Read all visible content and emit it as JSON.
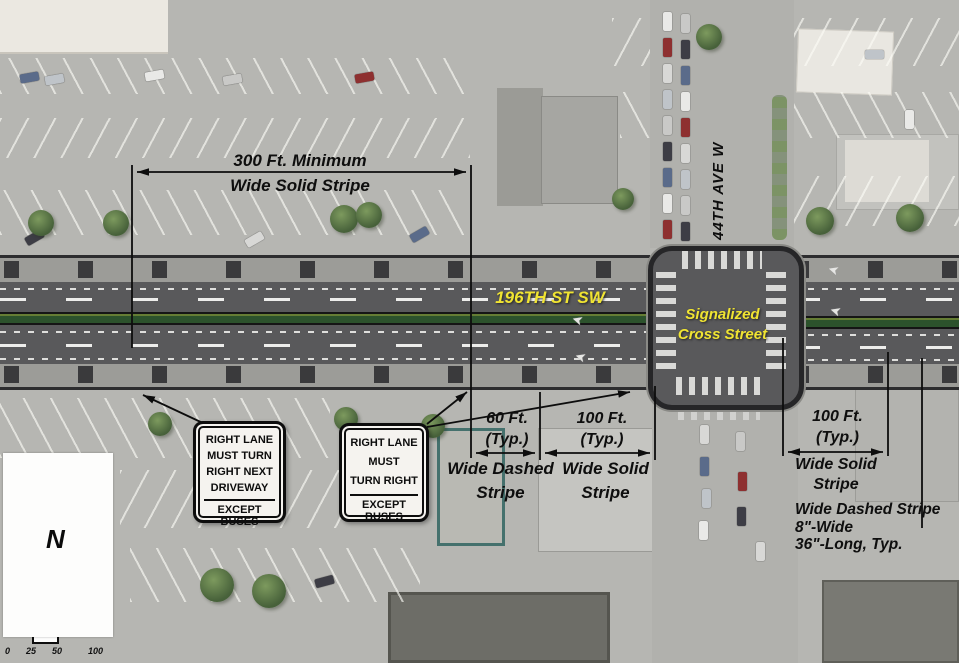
{
  "road_labels": {
    "main_street": "196TH ST SW",
    "cross_street_line1": "Signalized",
    "cross_street_line2": "Cross Street",
    "avenue": "44TH AVE W"
  },
  "annotations": {
    "dim300": {
      "line1": "300 Ft. Minimum",
      "line2": "Wide Solid Stripe"
    },
    "dim60": {
      "value": "60 Ft.",
      "typ": "(Typ.)",
      "label_line1": "Wide Dashed",
      "label_line2": "Stripe"
    },
    "dim100_center": {
      "value": "100 Ft.",
      "typ": "(Typ.)",
      "label_line1": "Wide Solid",
      "label_line2": "Stripe"
    },
    "dim100_east": {
      "value": "100 Ft.",
      "typ": "(Typ.)",
      "label_line1": "Wide Solid",
      "label_line2": "Stripe"
    },
    "dashed_note": {
      "line1": "Wide Dashed Stripe",
      "line2": "8\"-Wide",
      "line3": "36\"-Long, Typ."
    }
  },
  "signs": {
    "sign1": {
      "lines": [
        "RIGHT LANE",
        "MUST TURN",
        "RIGHT NEXT",
        "DRIVEWAY"
      ],
      "footer": "EXCEPT BUSES"
    },
    "sign2": {
      "lines": [
        "RIGHT LANE",
        "MUST",
        "TURN RIGHT"
      ],
      "footer": "EXCEPT BUSES"
    }
  },
  "map_furniture": {
    "north_label": "N",
    "scale_labels": [
      "0",
      "25",
      "50",
      "100"
    ],
    "road_arrow_glyph": "➤"
  },
  "colors": {
    "asphalt": "#59595b",
    "median_green": "#2c522c",
    "label_yellow": "#f0e432",
    "annotation_black": "#0e0e0e",
    "sign_background": "#f5f3ef"
  }
}
